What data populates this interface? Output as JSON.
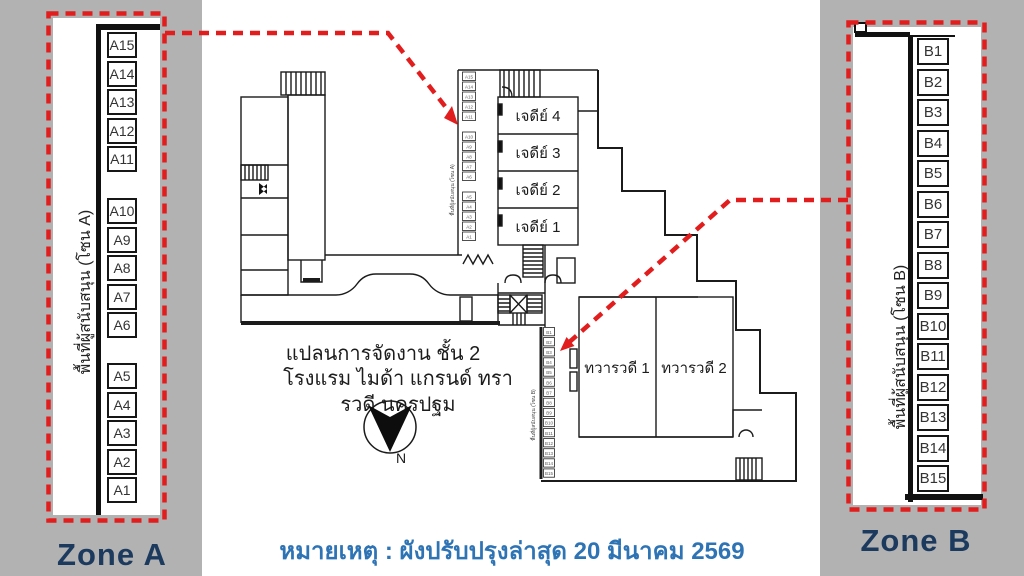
{
  "zone_a": {
    "label": "Zone A",
    "side_label": "พื้นที่ผู้สนับสนุน (โซน A)",
    "booths": [
      "A15",
      "A14",
      "A13",
      "A12",
      "A11",
      "A10",
      "A9",
      "A8",
      "A7",
      "A6",
      "A5",
      "A4",
      "A3",
      "A2",
      "A1"
    ]
  },
  "zone_b": {
    "label": "Zone B",
    "side_label": "พื้นที่ผู้สนับสนุน (โซน B)",
    "booths": [
      "B1",
      "B2",
      "B3",
      "B4",
      "B5",
      "B6",
      "B7",
      "B8",
      "B9",
      "B10",
      "B11",
      "B12",
      "B13",
      "B14",
      "B15"
    ]
  },
  "plan": {
    "title_line1": "แปลนการจัดงาน ชั้น 2",
    "title_line2": "โรงแรม ไมด้า  แกรนด์ ทรารวดี นครปฐม",
    "rooms": [
      {
        "label": "เจดีย์ 4"
      },
      {
        "label": "เจดีย์ 3"
      },
      {
        "label": "เจดีย์ 2"
      },
      {
        "label": "เจดีย์ 1"
      },
      {
        "label": "ทวารวดี 1"
      },
      {
        "label": "ทวารวดี 2"
      }
    ],
    "mini_zone_a_label": "พื้นที่ผู้สนับสนุน (โซน A)",
    "mini_zone_b_label": "พื้นที่ผู้สนับสนุน (โซน B)",
    "compass_label": "N"
  },
  "note": {
    "text": "หมายเหตุ : ผังปรับปรุงล่าสุด 20 มีนาคม 2569"
  },
  "colors": {
    "highlight_red": "#e21d1d",
    "zone_label_navy": "#1c3a5e",
    "note_blue": "#2e74b5",
    "side_strip_gray": "#b2b2b2"
  }
}
